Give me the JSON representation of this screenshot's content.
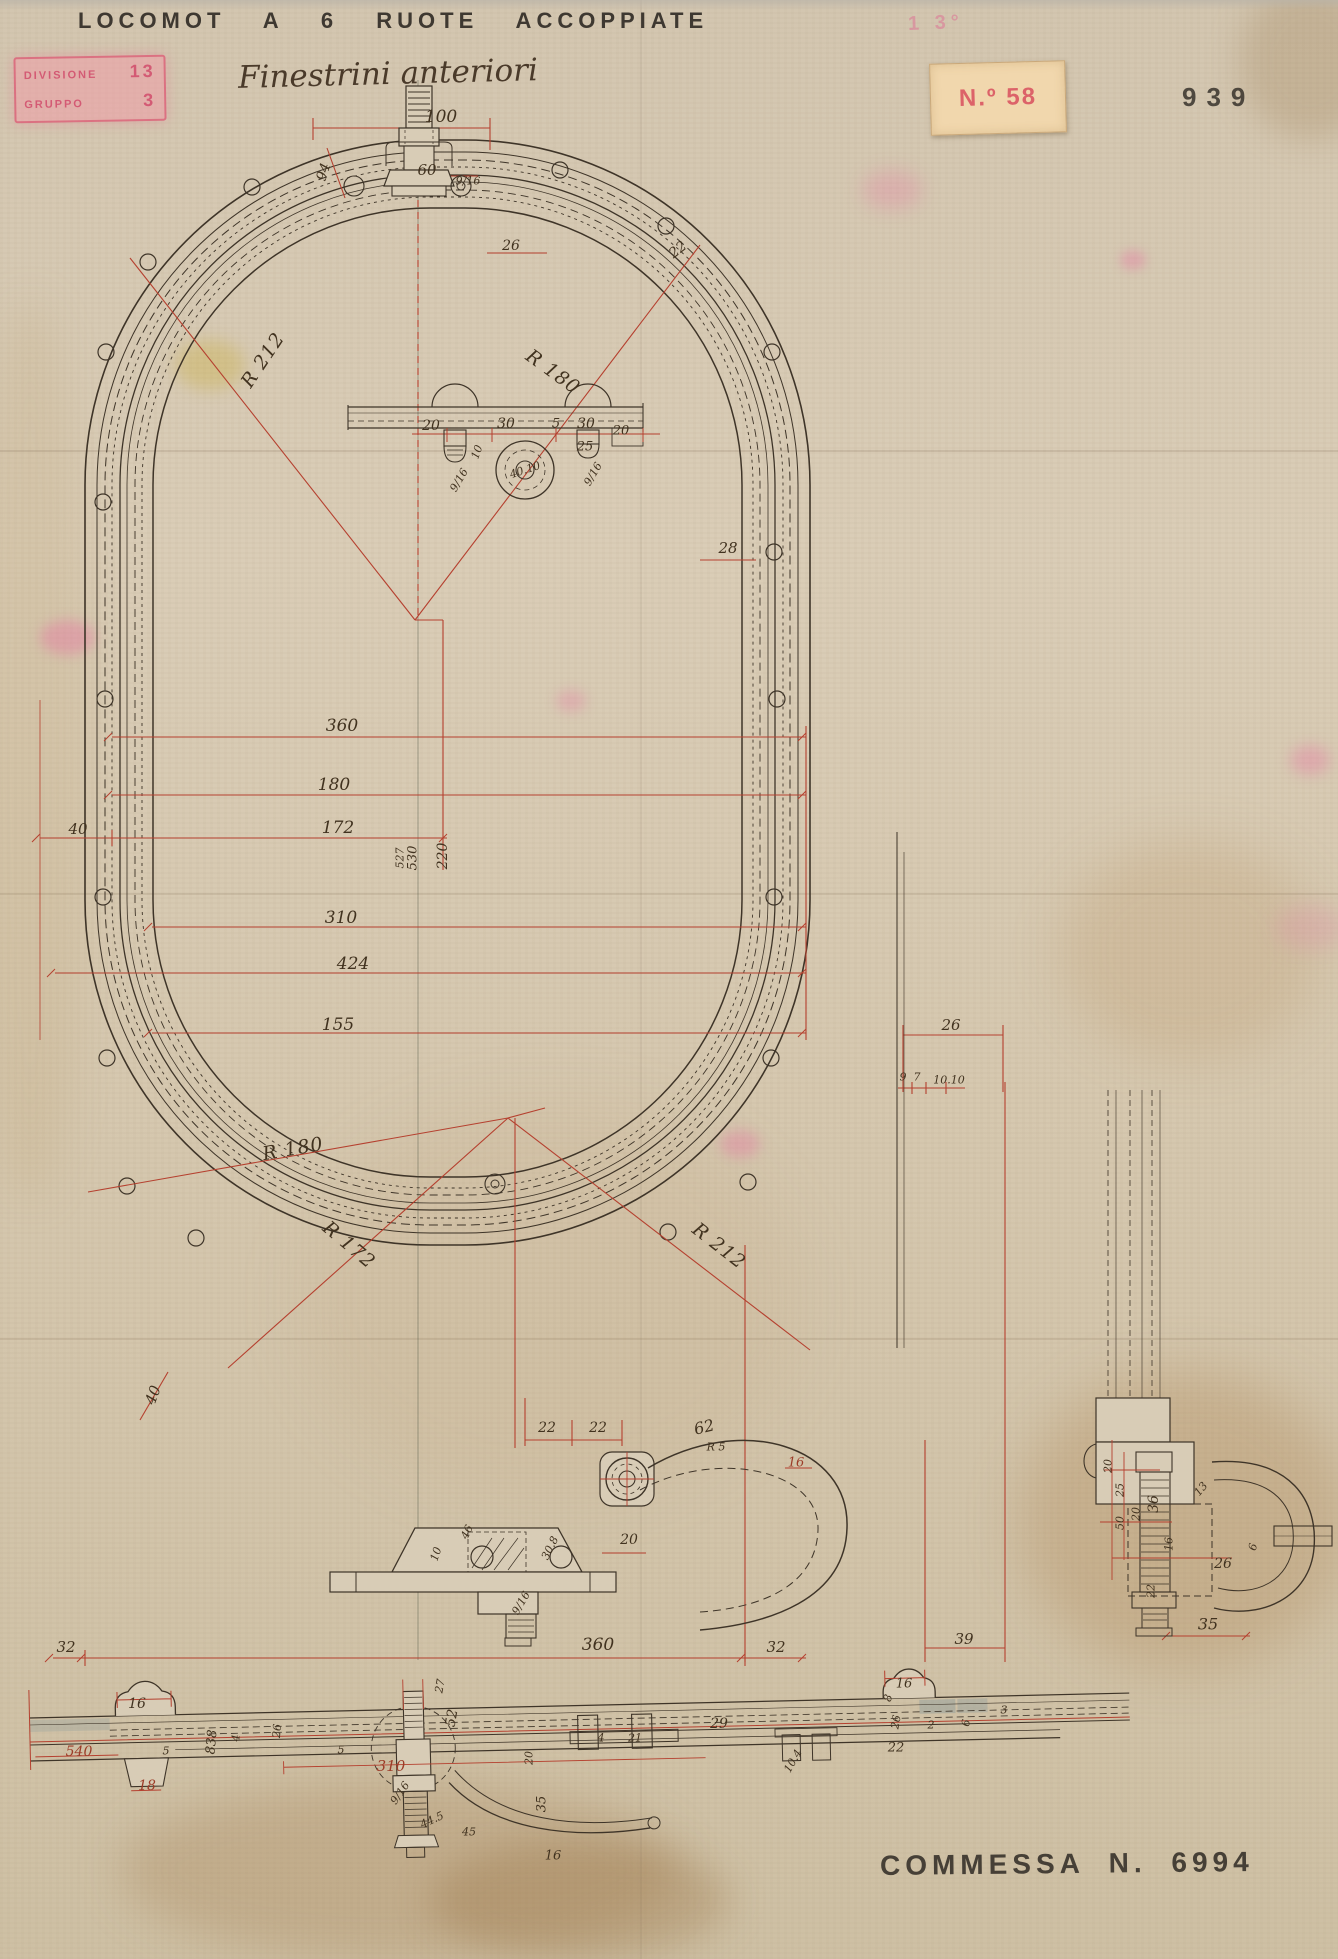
{
  "header": {
    "title": "LOCOMOT A 6 RUOTE ACCOPPIATE",
    "subtitle": "Finestrini anteriori",
    "division_label": "DIVISIONE",
    "division_value": "13",
    "group_label": "GRUPPO",
    "group_value": "3",
    "tag_number": "N.º 58",
    "page_number": "939",
    "faint_stamp": "1 3°"
  },
  "footer": {
    "commessa": "COMMESSA N. 6994"
  },
  "colors": {
    "paper": "#d8cbb5",
    "ink": "#3e3428",
    "dim_red": "#b5402f",
    "stamp_pink": "#d84a6e",
    "sticker": "#f1d7ad",
    "stencil_ink": "#2f2a24"
  },
  "drawing": {
    "annotations": [
      {
        "t": "100",
        "x": 441,
        "y": 117,
        "c": "d"
      },
      {
        "t": "60",
        "x": 427,
        "y": 170,
        "c": "d",
        "s": 15
      },
      {
        "t": "9/16",
        "x": 468,
        "y": 181,
        "c": "t"
      },
      {
        "t": "94",
        "x": 324,
        "y": 172,
        "r": -72,
        "c": "d",
        "s": 14
      },
      {
        "t": "26",
        "x": 511,
        "y": 246,
        "c": "d",
        "s": 14
      },
      {
        "t": "22",
        "x": 678,
        "y": 250,
        "r": -38,
        "c": "d",
        "s": 14
      },
      {
        "t": "R 212",
        "x": 263,
        "y": 360,
        "r": -56,
        "c": "rad"
      },
      {
        "t": "R 180",
        "x": 553,
        "y": 372,
        "r": 36,
        "c": "rad"
      },
      {
        "t": "20",
        "x": 431,
        "y": 426,
        "c": "d",
        "s": 14
      },
      {
        "t": "30",
        "x": 506,
        "y": 424,
        "c": "d",
        "s": 14
      },
      {
        "t": "5",
        "x": 556,
        "y": 424,
        "c": "d",
        "s": 13
      },
      {
        "t": "30",
        "x": 586,
        "y": 424,
        "c": "d",
        "s": 14
      },
      {
        "t": "20",
        "x": 621,
        "y": 431,
        "c": "d",
        "s": 13
      },
      {
        "t": "25",
        "x": 585,
        "y": 447,
        "c": "d",
        "s": 13
      },
      {
        "t": "10",
        "x": 477,
        "y": 452,
        "r": -70,
        "c": "t"
      },
      {
        "t": "9/16",
        "x": 459,
        "y": 480,
        "r": -60,
        "c": "t"
      },
      {
        "t": "9/16",
        "x": 593,
        "y": 474,
        "r": -60,
        "c": "t"
      },
      {
        "t": "40.10",
        "x": 525,
        "y": 470,
        "r": -18,
        "c": "t"
      },
      {
        "t": "28",
        "x": 728,
        "y": 548,
        "c": "d",
        "s": 15
      },
      {
        "t": "360",
        "x": 342,
        "y": 726,
        "c": "d"
      },
      {
        "t": "180",
        "x": 334,
        "y": 785,
        "c": "d"
      },
      {
        "t": "172",
        "x": 338,
        "y": 828,
        "c": "d"
      },
      {
        "t": "40",
        "x": 78,
        "y": 829,
        "c": "d",
        "s": 15
      },
      {
        "t": "527",
        "x": 400,
        "y": 858,
        "r": -90,
        "c": "t"
      },
      {
        "t": "530",
        "x": 413,
        "y": 858,
        "r": -90,
        "c": "d",
        "s": 13
      },
      {
        "t": "220",
        "x": 443,
        "y": 856,
        "r": -90,
        "c": "d",
        "s": 14
      },
      {
        "t": "310",
        "x": 341,
        "y": 918,
        "c": "d"
      },
      {
        "t": "424",
        "x": 353,
        "y": 964,
        "c": "d"
      },
      {
        "t": "155",
        "x": 338,
        "y": 1025,
        "c": "d"
      },
      {
        "t": "R 180",
        "x": 293,
        "y": 1149,
        "r": -10,
        "c": "rad"
      },
      {
        "t": "R 172",
        "x": 349,
        "y": 1245,
        "r": 40,
        "c": "rad"
      },
      {
        "t": "R 212",
        "x": 719,
        "y": 1246,
        "r": 38,
        "c": "rad"
      },
      {
        "t": "40",
        "x": 153,
        "y": 1395,
        "r": -70,
        "c": "d",
        "s": 15
      },
      {
        "t": "22",
        "x": 547,
        "y": 1428,
        "c": "d",
        "s": 14
      },
      {
        "t": "22",
        "x": 598,
        "y": 1428,
        "c": "d",
        "s": 14
      },
      {
        "t": "62",
        "x": 704,
        "y": 1427,
        "r": -14,
        "c": "d",
        "s": 16
      },
      {
        "t": "R 5",
        "x": 716,
        "y": 1447,
        "c": "t"
      },
      {
        "t": "16",
        "x": 796,
        "y": 1463,
        "c": "dr",
        "s": 13
      },
      {
        "t": "20",
        "x": 629,
        "y": 1540,
        "c": "d",
        "s": 14
      },
      {
        "t": "10",
        "x": 436,
        "y": 1554,
        "r": -72,
        "c": "t"
      },
      {
        "t": "46",
        "x": 467,
        "y": 1532,
        "r": -64,
        "c": "t"
      },
      {
        "t": "30.8",
        "x": 550,
        "y": 1548,
        "r": -64,
        "c": "t"
      },
      {
        "t": "9/16",
        "x": 521,
        "y": 1603,
        "r": -60,
        "c": "t"
      },
      {
        "t": "32",
        "x": 66,
        "y": 1647,
        "c": "d",
        "s": 15
      },
      {
        "t": "360",
        "x": 598,
        "y": 1645,
        "c": "d"
      },
      {
        "t": "32",
        "x": 776,
        "y": 1647,
        "c": "d",
        "s": 15
      },
      {
        "t": "39",
        "x": 964,
        "y": 1639,
        "c": "d",
        "s": 15
      },
      {
        "t": "16",
        "x": 137,
        "y": 1704,
        "c": "d",
        "s": 14
      },
      {
        "t": "540",
        "x": 79,
        "y": 1752,
        "c": "dr",
        "s": 14
      },
      {
        "t": "18",
        "x": 147,
        "y": 1786,
        "c": "dr",
        "s": 14
      },
      {
        "t": "5",
        "x": 166,
        "y": 1751,
        "c": "t"
      },
      {
        "t": "838",
        "x": 212,
        "y": 1742,
        "r": -85,
        "c": "d",
        "s": 13
      },
      {
        "t": "4",
        "x": 236,
        "y": 1738,
        "r": -85,
        "c": "t"
      },
      {
        "t": "26",
        "x": 277,
        "y": 1731,
        "r": -85,
        "c": "t"
      },
      {
        "t": "5",
        "x": 341,
        "y": 1750,
        "c": "t"
      },
      {
        "t": "310",
        "x": 391,
        "y": 1766,
        "c": "dr",
        "s": 15
      },
      {
        "t": "27",
        "x": 440,
        "y": 1686,
        "r": -80,
        "c": "t"
      },
      {
        "t": "52",
        "x": 452,
        "y": 1718,
        "r": -80,
        "c": "d",
        "s": 14
      },
      {
        "t": "9/16",
        "x": 400,
        "y": 1793,
        "r": -55,
        "c": "t"
      },
      {
        "t": "44.5",
        "x": 432,
        "y": 1820,
        "r": -25,
        "c": "t"
      },
      {
        "t": "45",
        "x": 469,
        "y": 1832,
        "c": "t"
      },
      {
        "t": "20",
        "x": 529,
        "y": 1758,
        "r": -90,
        "c": "t"
      },
      {
        "t": "35",
        "x": 542,
        "y": 1804,
        "r": -90,
        "c": "d",
        "s": 13
      },
      {
        "t": "16",
        "x": 553,
        "y": 1856,
        "c": "d",
        "s": 13
      },
      {
        "t": "4",
        "x": 601,
        "y": 1738,
        "c": "t"
      },
      {
        "t": "21",
        "x": 635,
        "y": 1738,
        "c": "t"
      },
      {
        "t": "29",
        "x": 719,
        "y": 1724,
        "c": "d",
        "s": 14
      },
      {
        "t": "10.4",
        "x": 793,
        "y": 1761,
        "r": -60,
        "c": "t"
      },
      {
        "t": "16",
        "x": 904,
        "y": 1684,
        "c": "d",
        "s": 13
      },
      {
        "t": "8",
        "x": 888,
        "y": 1698,
        "r": -75,
        "c": "t"
      },
      {
        "t": "26",
        "x": 896,
        "y": 1722,
        "r": -80,
        "c": "t"
      },
      {
        "t": "22",
        "x": 896,
        "y": 1748,
        "c": "d",
        "s": 13
      },
      {
        "t": "2",
        "x": 931,
        "y": 1725,
        "c": "t"
      },
      {
        "t": "6",
        "x": 966,
        "y": 1723,
        "r": -80,
        "c": "t"
      },
      {
        "t": "3",
        "x": 1004,
        "y": 1710,
        "c": "t"
      },
      {
        "t": "26",
        "x": 951,
        "y": 1025,
        "c": "d",
        "s": 15
      },
      {
        "t": "9",
        "x": 903,
        "y": 1077,
        "c": "t"
      },
      {
        "t": "7",
        "x": 917,
        "y": 1077,
        "c": "t"
      },
      {
        "t": "10.10",
        "x": 949,
        "y": 1080,
        "c": "t"
      },
      {
        "t": "20",
        "x": 1108,
        "y": 1466,
        "r": -90,
        "c": "t"
      },
      {
        "t": "25",
        "x": 1120,
        "y": 1490,
        "r": -90,
        "c": "t"
      },
      {
        "t": "50",
        "x": 1120,
        "y": 1523,
        "r": -90,
        "c": "t"
      },
      {
        "t": "20",
        "x": 1136,
        "y": 1514,
        "r": -90,
        "c": "t"
      },
      {
        "t": "36",
        "x": 1154,
        "y": 1504,
        "r": -90,
        "c": "d",
        "s": 14
      },
      {
        "t": "13",
        "x": 1201,
        "y": 1489,
        "r": -50,
        "c": "t"
      },
      {
        "t": "16",
        "x": 1169,
        "y": 1544,
        "r": -90,
        "c": "t"
      },
      {
        "t": "26",
        "x": 1223,
        "y": 1564,
        "c": "d",
        "s": 14
      },
      {
        "t": "6",
        "x": 1253,
        "y": 1547,
        "r": -75,
        "c": "t"
      },
      {
        "t": "22",
        "x": 1151,
        "y": 1591,
        "r": -90,
        "c": "t"
      },
      {
        "t": "35",
        "x": 1208,
        "y": 1624,
        "c": "d",
        "s": 16
      }
    ]
  }
}
